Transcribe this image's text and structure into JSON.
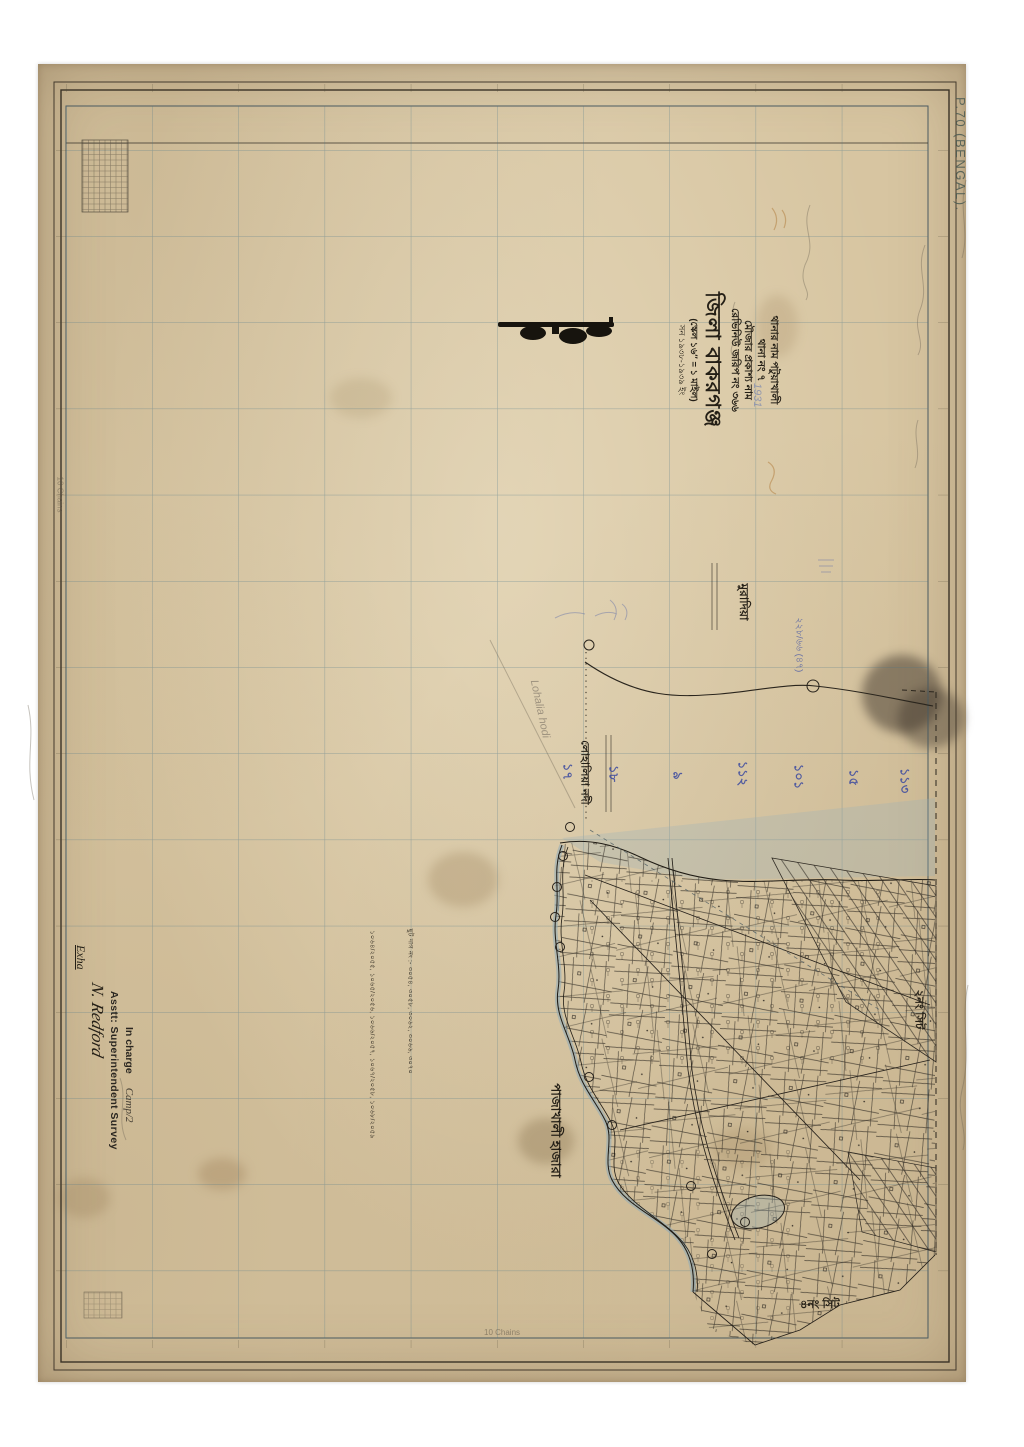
{
  "sheet": {
    "plate_label": "P.70 (BENGAL).",
    "chains_label_bottom": "10 Chains",
    "chains_label_left": "10 Chains"
  },
  "title_block": {
    "thana_line": "থানার নাম পটুয়াখালী",
    "thana_no_line": "থানা নং ৭",
    "mouza_line": "মৌজার প্রকাশ্য নাম",
    "revenue_line": "রেভিনিউ জরিপ নং ৩৬৬",
    "revenue_hand_note": "1931",
    "district_line": "জিলা বাকরগঞ্জ",
    "scale_line": "(স্কেল ১৬″ = ১ মাইল)",
    "year_line": "সন ১৯৩৮-১৯৩৯ ইং"
  },
  "map_labels": {
    "village_north": "মুরাদিয়া",
    "river_name": "লোহালিয়া নদী",
    "river_name_pencil": "Lohalia hodi",
    "village_south": "পাজাখালী হাজারা",
    "sheet_note_east": "২নং সিট",
    "sheet_note_south": "৪নং সিট",
    "blue_fraction_note": "২২৮/৬৬ (৪৭)",
    "station_numbers": [
      "১৭",
      "১৮",
      "৯",
      "১১২",
      "১০১",
      "১৫",
      "১১৩"
    ]
  },
  "notes": {
    "chhut_dag_line": "ছুট দাগ নং :- ৩০৫৪, ৩০৫৮, ৩০৬২, ৩০৬৬, ৩০৭০",
    "fraction_line": "১০৬৪/২০৫৫, ১০৬৫/২০৫৬, ১০৬৬/২০৫৭, ১০৬৭/২০৫৮, ১০৬৮/২০৫৯"
  },
  "signature_block": {
    "hand_note": "Exha",
    "signature": "N. Redford",
    "stamp_title": "Asstt: Superintendent Survey",
    "stamp_sub": "In charge",
    "camp_note": "Camp/2"
  }
}
